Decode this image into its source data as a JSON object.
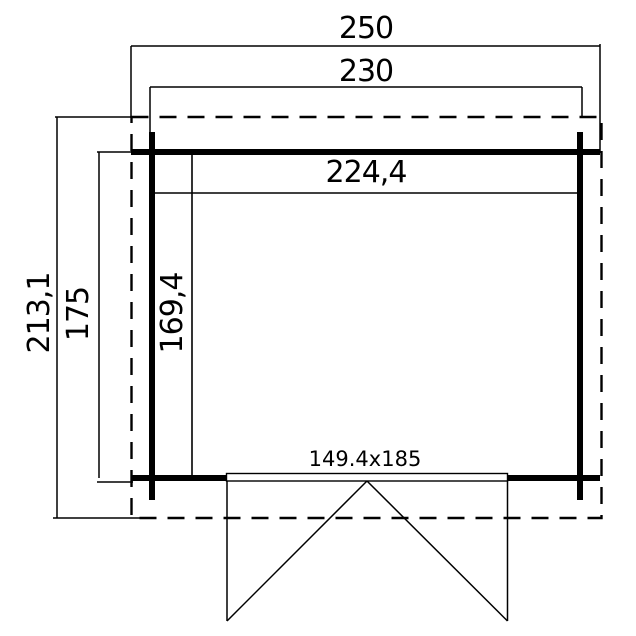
{
  "title": "Shed floor plan",
  "dims": {
    "outer_width": "250",
    "wall_width": "230",
    "inner_width": "224,4",
    "outer_depth": "213,1",
    "wall_depth": "175",
    "inner_depth": "169,4",
    "door_size": "149.4x185"
  },
  "values": {
    "outer_width_cm": 250,
    "wall_width_cm": 230,
    "inner_width_cm": 224.4,
    "outer_depth_cm": 213.1,
    "wall_depth_cm": 175,
    "inner_depth_cm": 169.4,
    "door_width_cm": 149.4,
    "door_height_cm": 185
  },
  "colors": {
    "line": "#000000",
    "background": "#ffffff"
  }
}
